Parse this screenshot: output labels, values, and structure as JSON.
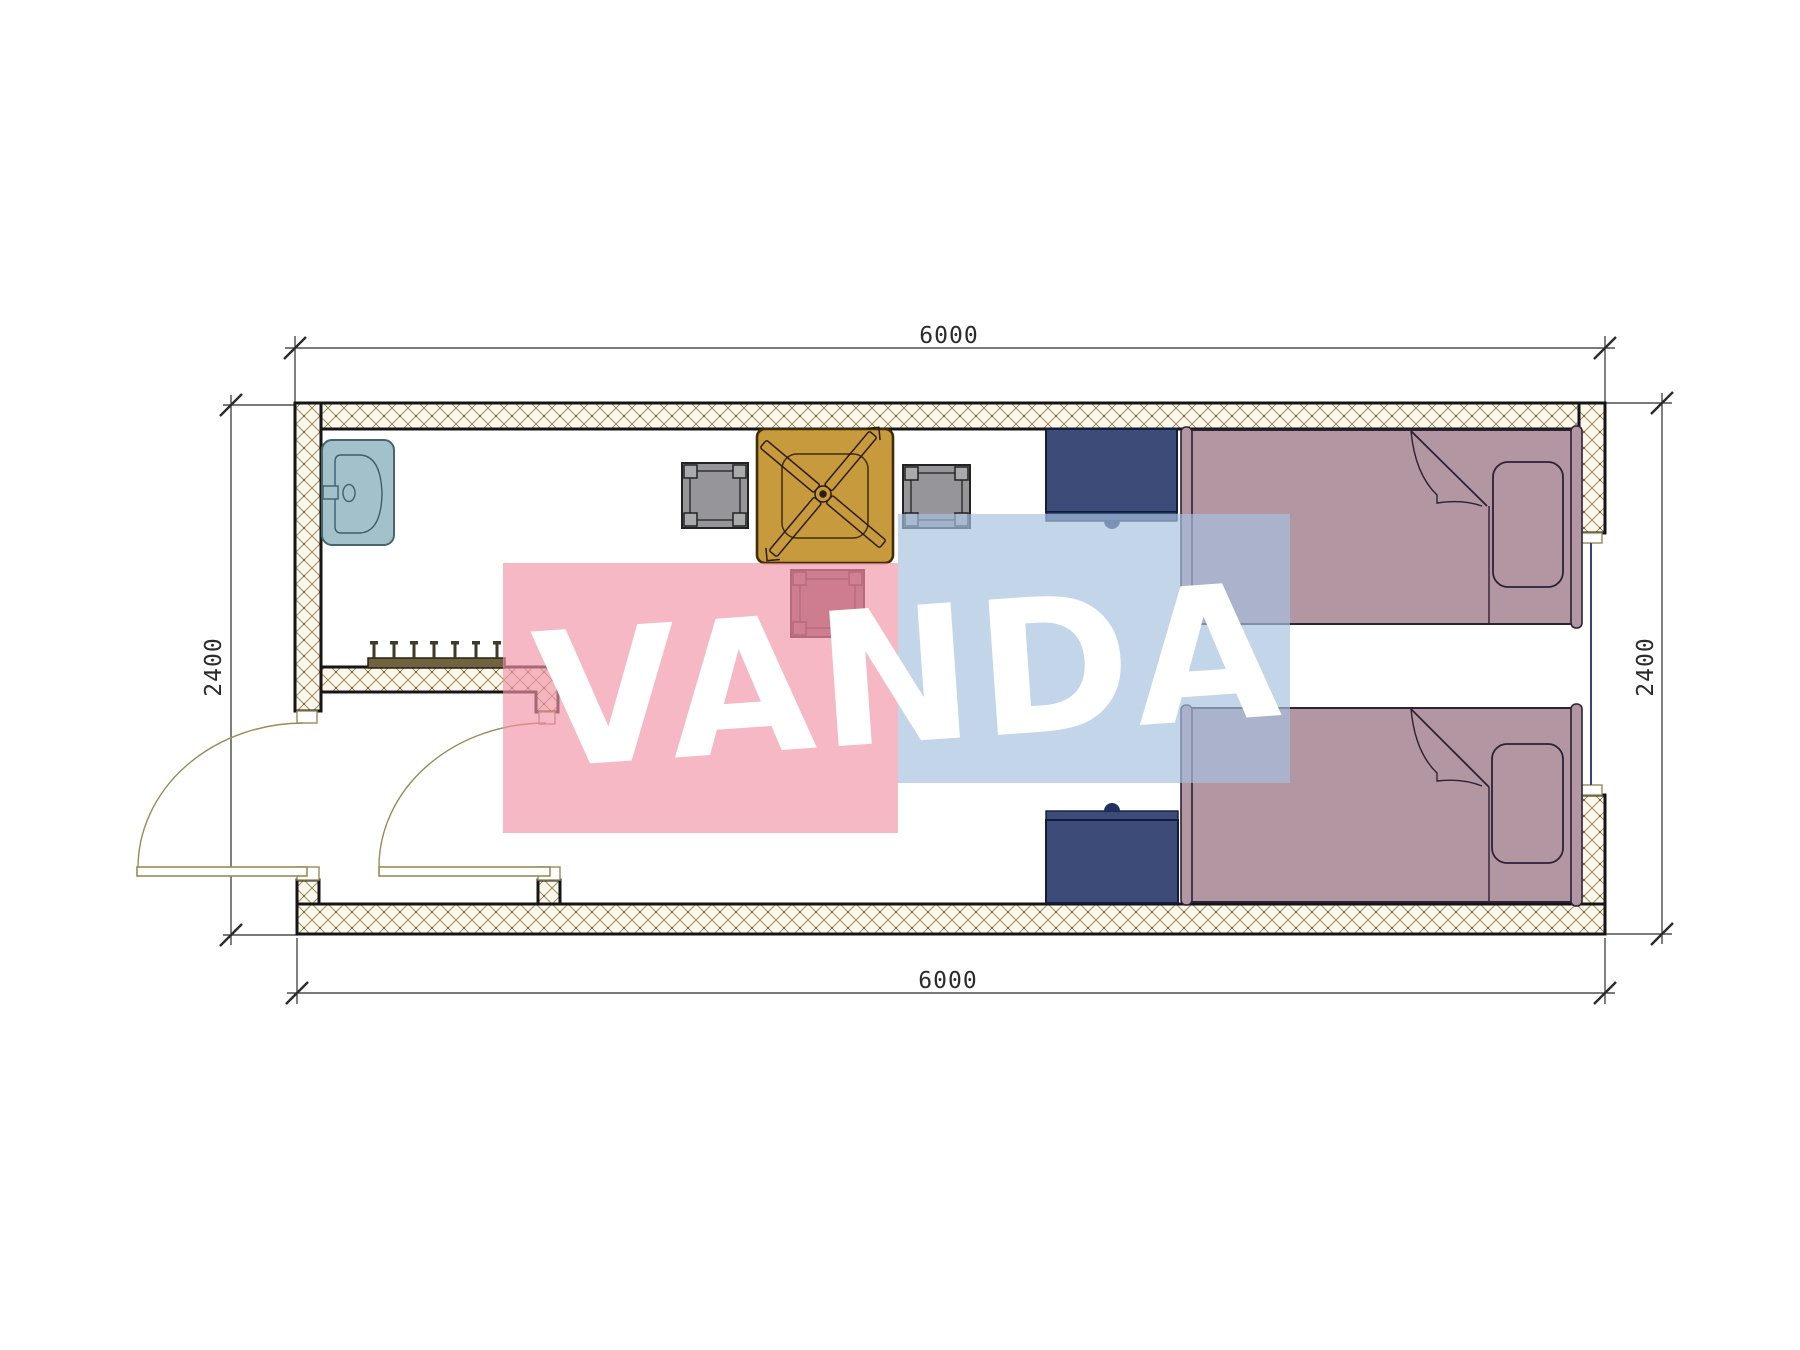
{
  "diagram": {
    "kind": "architectural floor plan",
    "room_outer_width_mm": "6000",
    "room_outer_depth_mm": "2400",
    "dimensions": {
      "top": "6000",
      "bottom": "6000",
      "left": "2400",
      "right": "2400"
    },
    "watermark": {
      "text": "VANDA",
      "text_color": "#ffffff",
      "pink_rect_color": "rgba(242,147,167,0.66)",
      "blue_rect_color": "rgba(167,193,222,0.68)"
    },
    "colors": {
      "wall_hatch_bg": "#faf6ea",
      "wall_hatch_line": "#8f7f52",
      "wall_outline": "#161616",
      "jamb_stroke": "#9a8a55",
      "door_stroke": "#9a8a55",
      "window_line": "#3a3f8f",
      "dim_line": "#2b2b2b",
      "sink": "#a2c1cb",
      "sink_stroke": "#47646f",
      "coat_rack": "#6f6340",
      "table": "#c79a3d",
      "table_stroke": "#3f2d05",
      "stool_gray": "#96969a",
      "stool_gray_corner": "#a9aaad",
      "stool_maroon": "#8a5260",
      "stool_maroon_corner": "#945d68",
      "nightstand": "#3d4b79",
      "nightstand_knob": "#203060",
      "bed": "#b296a1",
      "bed_stroke": "#2c2135"
    },
    "furniture": [
      {
        "name": "sink"
      },
      {
        "name": "coat-rack-with-hooks"
      },
      {
        "name": "table-with-ceiling-fan-symbol"
      },
      {
        "name": "stool-gray-left"
      },
      {
        "name": "stool-gray-right"
      },
      {
        "name": "stool-maroon"
      },
      {
        "name": "nightstand-top"
      },
      {
        "name": "nightstand-bottom"
      },
      {
        "name": "single-bed-top"
      },
      {
        "name": "single-bed-bottom"
      },
      {
        "name": "entry-door-left"
      },
      {
        "name": "entry-door-right"
      },
      {
        "name": "window-right"
      }
    ]
  }
}
